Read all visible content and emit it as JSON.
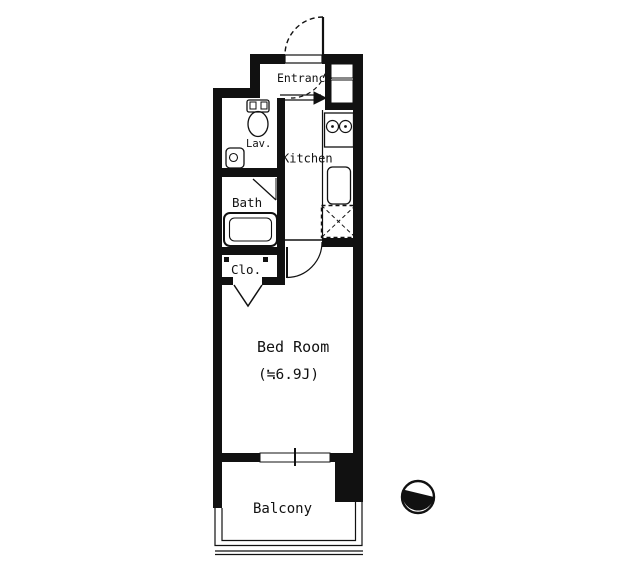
{
  "floor_plan": {
    "type": "apartment-floor-plan",
    "colors": {
      "wall": "#111111",
      "background": "#ffffff"
    },
    "rooms": {
      "entrance": {
        "label": "Entrance"
      },
      "lavatory": {
        "label": "Lav."
      },
      "kitchen": {
        "label": "Kitchen"
      },
      "bath": {
        "label": "Bath"
      },
      "closet": {
        "label": "Clo."
      },
      "bedroom": {
        "label": "Bed Room",
        "size": "(≒6.9J)"
      },
      "balcony": {
        "label": "Balcony"
      }
    },
    "fixtures": {
      "toilet": "toilet",
      "lav_sink": "hand-wash-sink",
      "bathtub": "bathtub",
      "stove": "two-burner-stove",
      "kitchen_sink": "kitchen-sink",
      "refrigerator_space": "refrigerator-space-dashed",
      "entrance_door": "swing-door",
      "bedroom_door": "swing-door",
      "closet_door": "folding-door",
      "window": "sliding-window",
      "compass": "north-compass"
    }
  }
}
